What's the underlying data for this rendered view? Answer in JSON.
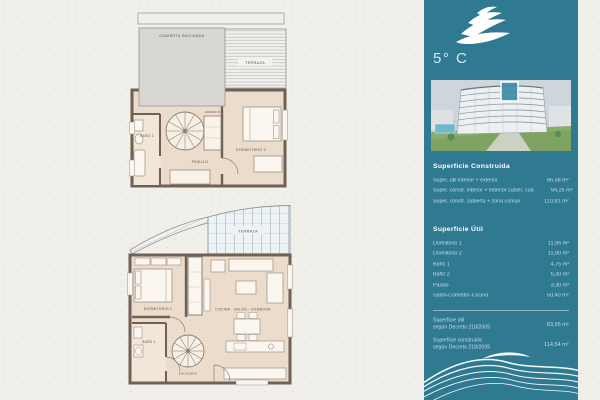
{
  "page": {
    "paper_color": "#f1efea",
    "sidebar_color": "#2f7991",
    "wall_color": "#6f6156",
    "floor_color": "#ecdccb",
    "roof_color": "#d8d7d3",
    "highlight_color": "#3d8ba4"
  },
  "sidebar": {
    "logo_icon": "wave-logo",
    "unit_label": "5° C",
    "construida": {
      "title": "Superficie Construida",
      "rows": [
        {
          "label": "Super. útil interior + exterior",
          "value": "86,58 m²"
        },
        {
          "label": "Super. constr. interior + exterior cubier. cub.",
          "value": "94,25 m²"
        },
        {
          "label": "Super. constr. cubierta + zona común",
          "value": "110,81 m²"
        }
      ]
    },
    "util": {
      "title": "Superficie Útil",
      "rows": [
        {
          "label": "Dormitorio 1",
          "value": "11,95 m²"
        },
        {
          "label": "Dormitorio 2",
          "value": "11,80 m²"
        },
        {
          "label": "Baño 1",
          "value": "4,75 m²"
        },
        {
          "label": "Baño 2",
          "value": "6,30 m²"
        },
        {
          "label": "Pasillo",
          "value": "3,30 m²"
        },
        {
          "label": "Salón-Comedor-Cocina",
          "value": "50,40 m²"
        }
      ]
    },
    "decreto": [
      {
        "line1": "Superficie útil",
        "line2": "según Decreto 218/2005",
        "value": "83,55 m²"
      },
      {
        "line1": "Superficie construida",
        "line2": "según Decreto 218/2005",
        "value": "114,54 m²"
      }
    ]
  },
  "plans": {
    "upper": {
      "labels": {
        "cubierta": "CUBIERTA INCLINADA",
        "terraza": "TERRAZA",
        "bano": "BAÑO 2",
        "armario": "ARMARIO",
        "pasillo": "PASILLO",
        "dormitorio": "DORMITORIO 2"
      }
    },
    "lower": {
      "labels": {
        "terraza": "TERRAZA",
        "dormitorio": "DORMITORIO 1",
        "salon": "COCINA - SALÓN - COMEDOR",
        "bano": "BAÑO 1",
        "escalera": "ESCALERA"
      }
    }
  }
}
